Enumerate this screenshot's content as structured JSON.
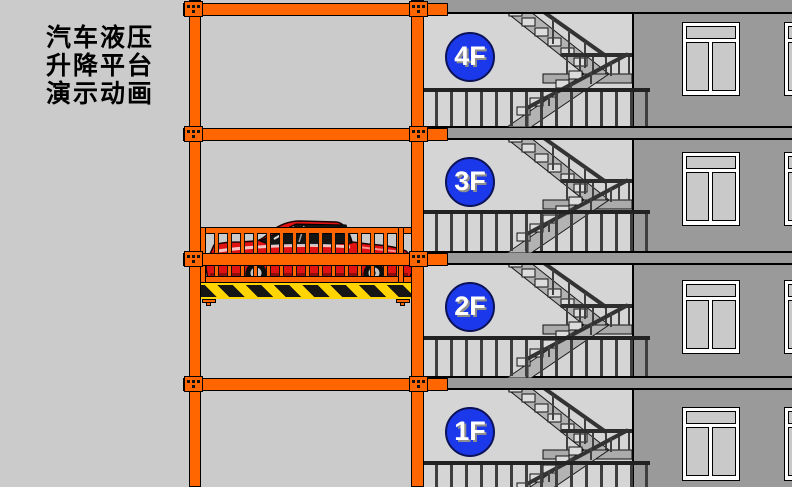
{
  "title": {
    "line1": "汽车液压",
    "line2": "升降平台",
    "line3": "演示动画"
  },
  "floors": [
    {
      "label": "4F"
    },
    {
      "label": "3F"
    },
    {
      "label": "2F"
    },
    {
      "label": "1F"
    }
  ],
  "colors": {
    "frame_orange": "#ff6600",
    "badge_blue": "#1b38ea",
    "badge_text": "#ffffff",
    "hazard_yellow": "#ffd400",
    "hazard_black": "#151515",
    "car_red": "#e01212",
    "building_wall_gray": "#9a9a9a",
    "stairwell_gray": "#d5d5d5",
    "background_gray": "#cbcbcb"
  }
}
